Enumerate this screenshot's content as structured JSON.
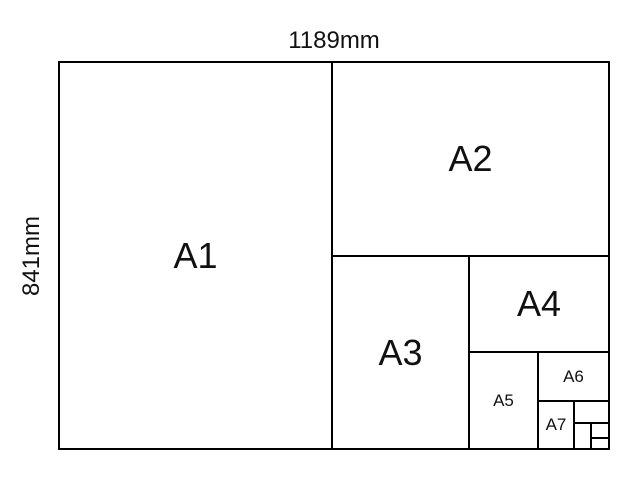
{
  "diagram": {
    "type": "paper-size-comparison",
    "width_label": "1189mm",
    "height_label": "841mm",
    "colors": {
      "line": "#000000",
      "text": "#111111",
      "background": "#ffffff"
    },
    "cells": {
      "a1": "A1",
      "a2": "A2",
      "a3": "A3",
      "a4": "A4",
      "a5": "A5",
      "a6": "A6",
      "a7": "A7",
      "a8": "",
      "a9": "",
      "a10": "",
      "a11": ""
    }
  }
}
